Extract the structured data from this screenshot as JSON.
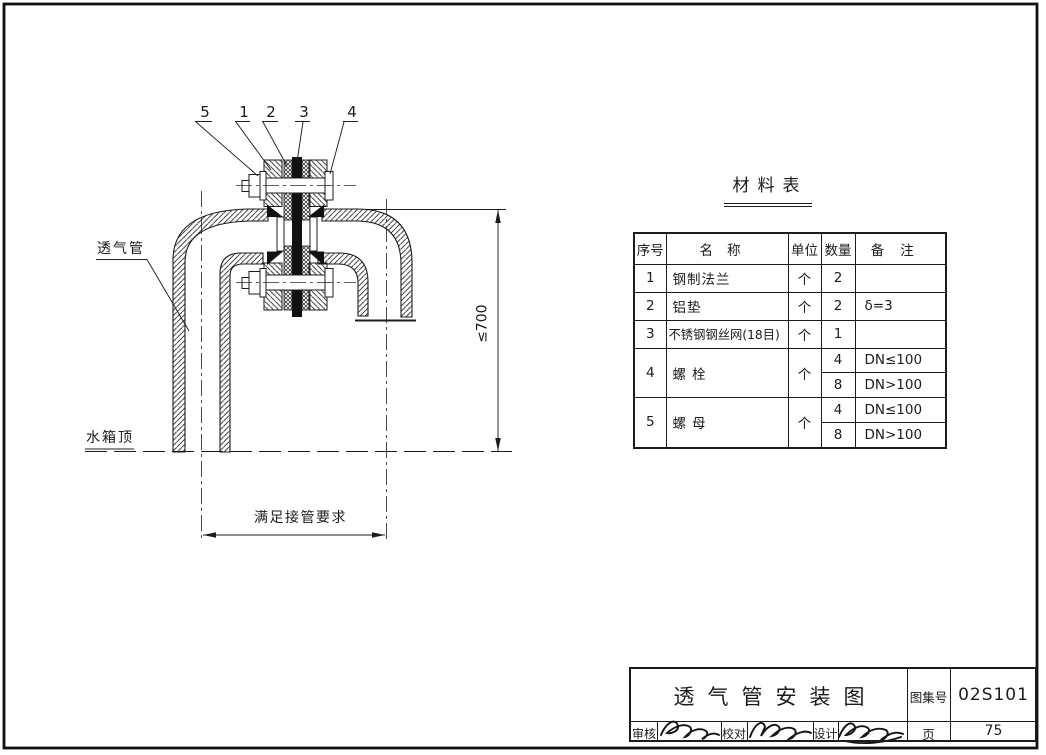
{
  "drawing": {
    "callouts": [
      "5",
      "1",
      "2",
      "3",
      "4"
    ],
    "vent_pipe_label": "透气管",
    "tank_top_label": "水箱顶",
    "span_dim_label": "满足接管要求",
    "height_dim_label": "≤700"
  },
  "materials_table": {
    "title": "材料表",
    "headers": {
      "no": "序号",
      "name": "名称",
      "unit": "单位",
      "qty": "数量",
      "note": "备注"
    },
    "rows": [
      {
        "no": "1",
        "name": "钢制法兰",
        "unit": "个",
        "qty": "2",
        "note": ""
      },
      {
        "no": "2",
        "name": "铝垫",
        "unit": "个",
        "qty": "2",
        "note": "δ=3"
      },
      {
        "no": "3",
        "name": "不锈钢钢丝网(18目)",
        "unit": "个",
        "qty": "1",
        "note": ""
      },
      {
        "no": "4",
        "name": "螺栓",
        "unit": "个",
        "sub": [
          {
            "qty": "4",
            "note": "DN≤100"
          },
          {
            "qty": "8",
            "note": "DN>100"
          }
        ]
      },
      {
        "no": "5",
        "name": "螺母",
        "unit": "个",
        "sub": [
          {
            "qty": "4",
            "note": "DN≤100"
          },
          {
            "qty": "8",
            "note": "DN>100"
          }
        ]
      }
    ]
  },
  "title_block": {
    "title": "透气管安装图",
    "atlas_label": "图集号",
    "atlas_number": "02S101",
    "reviewer_label": "审核",
    "checker_label": "校对",
    "designer_label": "设计",
    "page_label": "页",
    "page_number": "75"
  }
}
